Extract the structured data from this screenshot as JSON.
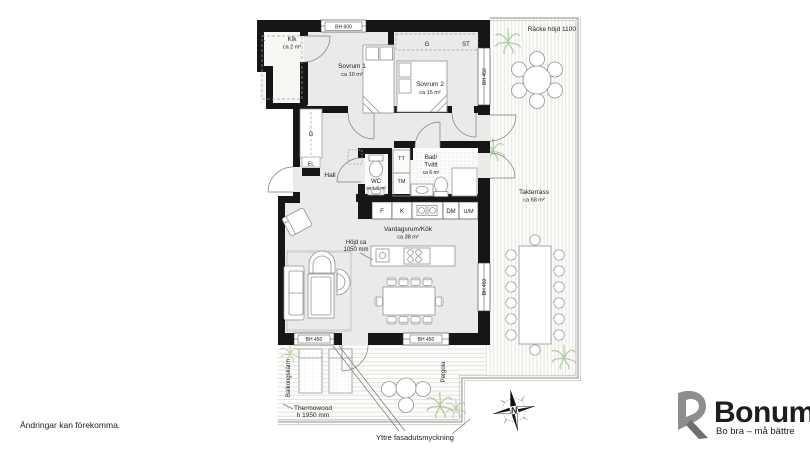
{
  "page": {
    "footer_note": "Ändringar kan förekomma."
  },
  "logo": {
    "name": "Bonum",
    "tagline": "Bo bra – må bättre",
    "orange": "#F28C00",
    "gray": "#8E8E8E"
  },
  "compass": {
    "north_label": "N"
  },
  "plan": {
    "rooms": {
      "klk": {
        "name": "Klk",
        "area": "ca 2 m²"
      },
      "sovrum1": {
        "name": "Sovrum 1",
        "area": "ca 10 m²"
      },
      "sovrum2": {
        "name": "Sovrum 2",
        "area": "ca 15 m²"
      },
      "wc": {
        "name": "WC",
        "area": "ca 1,5 m²"
      },
      "bad": {
        "name_line1": "Bad/",
        "name_line2": "Tvätt",
        "area": "ca 6 m²"
      },
      "hall": {
        "name": "Hall"
      },
      "vardagsrum": {
        "name": "Vardagsrum/Kök",
        "area": "ca 38 m²"
      },
      "takterrass": {
        "name": "Takterrass",
        "area": "ca 68 m²"
      }
    },
    "fixtures": {
      "l": "L",
      "g_wardrobe": "G",
      "st": "ST",
      "g_closet": "G",
      "el": "EL",
      "tt": "TT",
      "tm": "TM",
      "f": "F",
      "k": "K",
      "dm": "DM",
      "um": "U/M"
    },
    "annotations": {
      "bh600": "BH 600",
      "bh450": "BH 450",
      "racke": "Räcke höjd 1100",
      "hojd_line1": "Höjd ca",
      "hojd_line2": "1050 mm",
      "balkongskarm": "Balkongskärm",
      "thermowood_line1": "Thermowood",
      "thermowood_line2": "h 1950 mm",
      "pergola": "Pergola",
      "yttre": "Yttre fasadutsmyckning"
    }
  }
}
